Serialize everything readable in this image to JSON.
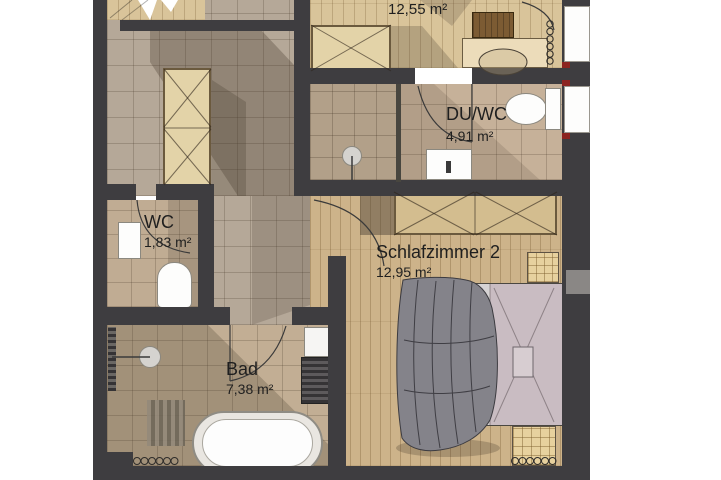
{
  "plan_type": "apartment-floor-plan",
  "rooms": [
    {
      "name": "",
      "area": "12,55 m²"
    },
    {
      "name": "DU/WC",
      "area": "4,91 m²"
    },
    {
      "name": "WC",
      "area": "1,83 m²"
    },
    {
      "name": "Schlafzimmer 2",
      "area": "12,95 m²"
    },
    {
      "name": "Bad",
      "area": "7,38 m²"
    }
  ],
  "fixtures": [
    "wardrobe-icon",
    "desk-icon",
    "chair-icon",
    "chest-icon",
    "shower-head-icon",
    "toilet-icon",
    "washbasin-icon",
    "bathtub-icon",
    "bed-icon",
    "duvet-icon",
    "nightstand-icon",
    "radiator-icon",
    "window-icon",
    "door-swing-arc-icon",
    "stair-cut-icon"
  ],
  "colors": {
    "wall": "#3e3d40",
    "wood_floor_top_room": "#d9c49a",
    "wood_floor_bedroom": "#cdb38a",
    "tile_floor": "#b5a898",
    "tile_floor_bath": "#c2ae94",
    "duvet_gray": "#84838a",
    "mattress_gray": "#d6d3d4",
    "bedding_mauve": "#c9bcc2",
    "furniture_wood": "#e3d3a8",
    "chest_brown": "#7c5b33",
    "fixture_white": "#fdfdfc",
    "window_marker_red": "#8c2420",
    "label_text": "#1f1f1f"
  }
}
